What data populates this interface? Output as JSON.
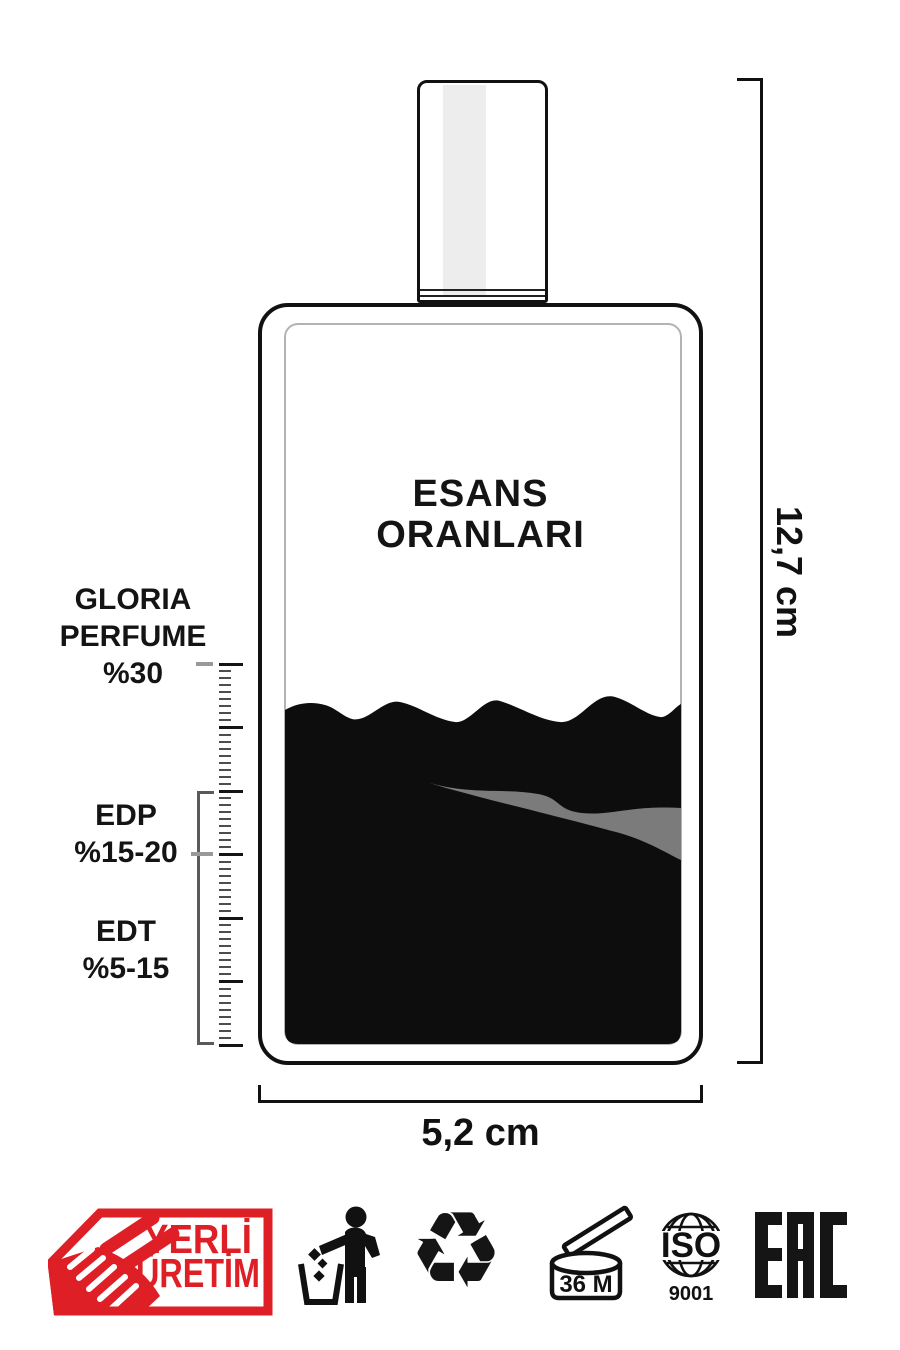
{
  "title": {
    "line1": "ESANS",
    "line2": "ORANLARI"
  },
  "scale_labels": {
    "gloria": {
      "line1": "GLORIA",
      "line2": "PERFUME",
      "line3": "%30"
    },
    "edp": {
      "line1": "EDP",
      "line2": "%15-20"
    },
    "edt": {
      "line1": "EDT",
      "line2": "%5-15"
    }
  },
  "dimensions": {
    "height_label": "12,7 cm",
    "width_label": "5,2 cm"
  },
  "badge": {
    "line1": "YERLİ",
    "line2": "ÜRETİM",
    "color": "#DE1F26"
  },
  "icons": {
    "recycle_glyph": "♻",
    "pao_label": "36 M",
    "iso_line1": "ISO",
    "iso_line2": "9001",
    "eac_label": "EAC",
    "tidyman_meaning": "dispose-of-properly",
    "recycle_meaning": "recyclable",
    "pao_meaning": "period-after-opening-36-months"
  },
  "colors": {
    "ink": "#111111",
    "liquid": "#0D0D0D",
    "streak": "#7B7B7B",
    "badge_red": "#DE1F26"
  }
}
